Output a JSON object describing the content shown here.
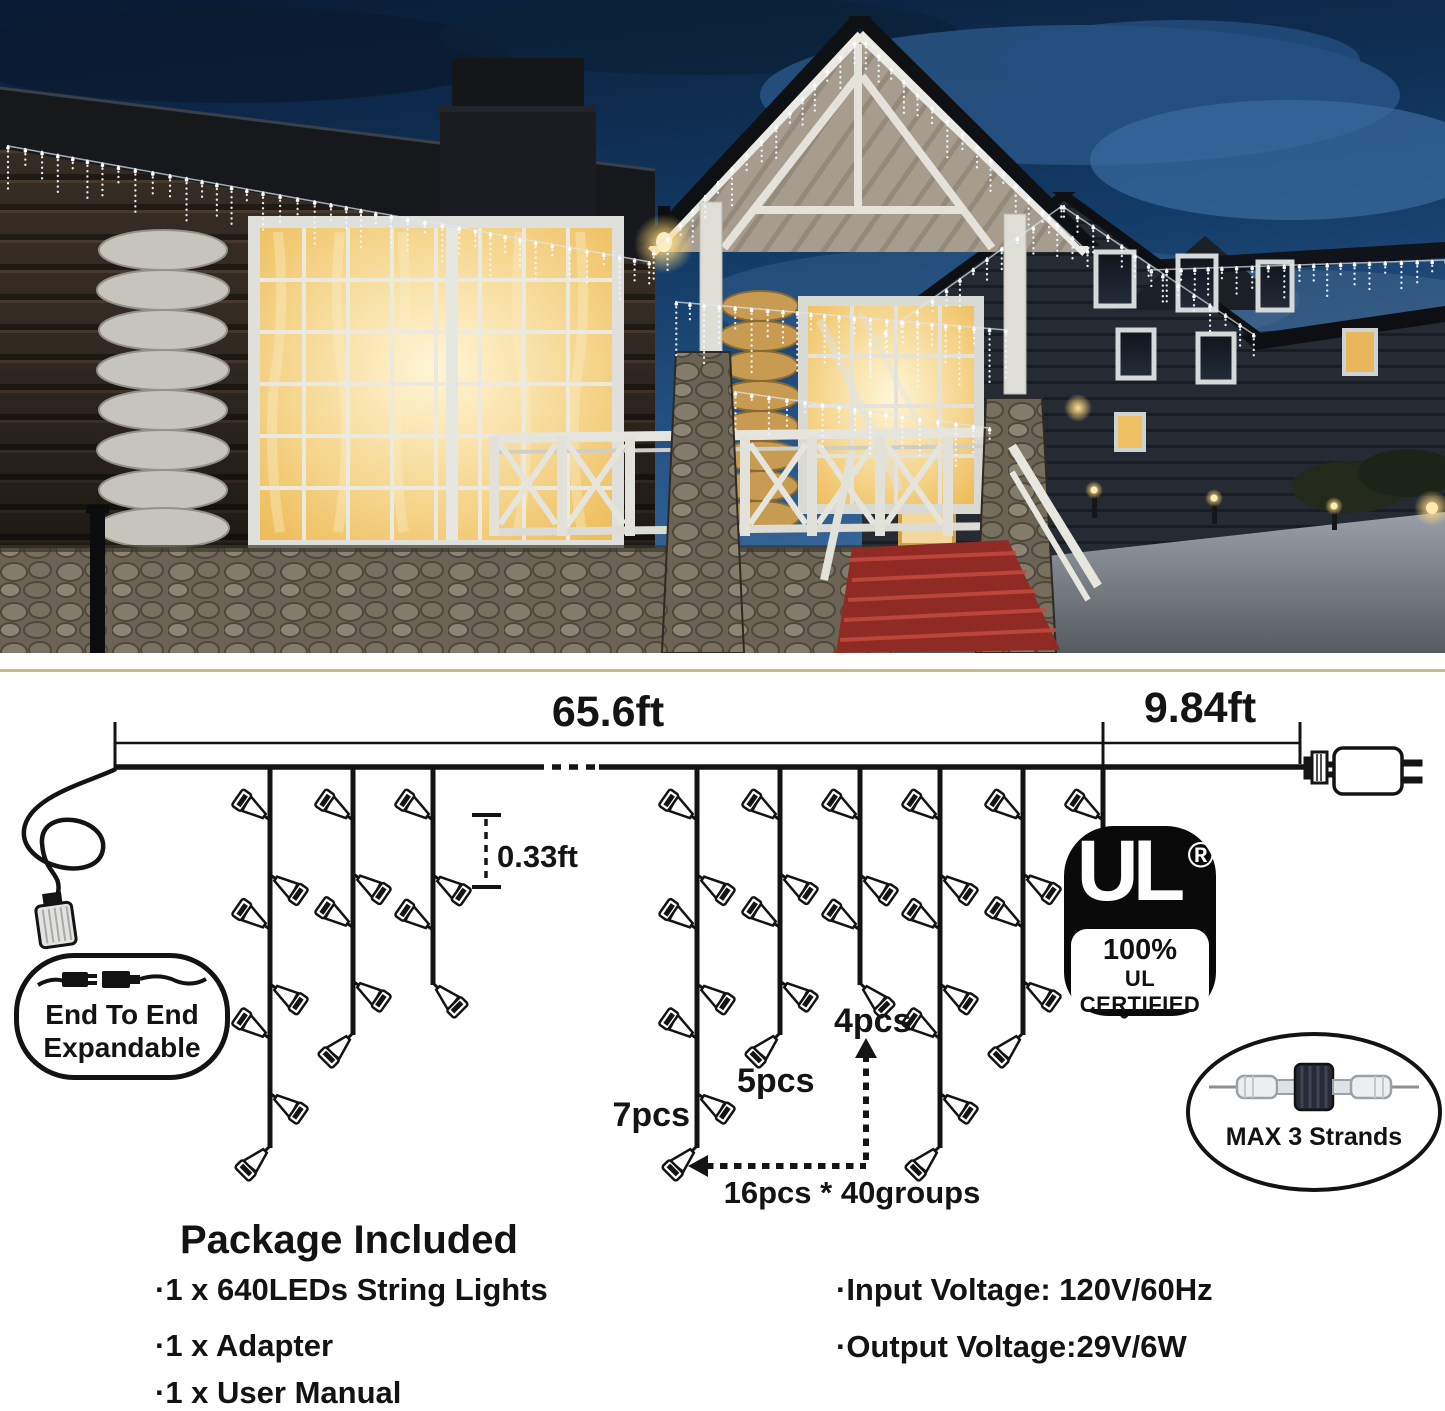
{
  "colors": {
    "divider": "#c9bb8b",
    "ink": "#131313",
    "window_glow": "#f3c96a",
    "carpet_red": "#8f2b24",
    "night_sky": "#143c68"
  },
  "photo": {
    "icon": "log-cabin-night-photo"
  },
  "diagram": {
    "dims": {
      "main_span": "65.6ft",
      "lead_span": "9.84ft",
      "drop_spacing": "0.33ft"
    },
    "drop_labels": {
      "long": "7pcs",
      "medium": "5pcs",
      "short": "4pcs"
    },
    "group_note": "16pcs * 40groups",
    "drops": [
      {
        "x": 270,
        "bulbs": 7,
        "bottom": 1148,
        "end": "L"
      },
      {
        "x": 353,
        "bulbs": 5,
        "bottom": 1035,
        "end": "L"
      },
      {
        "x": 433,
        "bulbs": 4,
        "bottom": 985,
        "end": "R"
      },
      {
        "x": 697,
        "bulbs": 7,
        "bottom": 1148,
        "end": "L"
      },
      {
        "x": 780,
        "bulbs": 5,
        "bottom": 1035,
        "end": "L"
      },
      {
        "x": 860,
        "bulbs": 4,
        "bottom": 985,
        "end": "R"
      },
      {
        "x": 940,
        "bulbs": 7,
        "bottom": 1148,
        "end": "L"
      },
      {
        "x": 1023,
        "bulbs": 5,
        "bottom": 1035,
        "end": "L"
      },
      {
        "x": 1103,
        "bulbs": 4,
        "bottom": 985,
        "end": "R"
      }
    ],
    "badge_end_to_end": {
      "line1": "End To End",
      "line2": "Expandable"
    },
    "badge_ul": {
      "brand": "UL",
      "registered": "®",
      "percent": "100%",
      "certified": "UL CERTIFIED"
    },
    "badge_connector": {
      "label": "MAX 3 Strands"
    },
    "package": {
      "title": "Package Included",
      "items": [
        "·1 x 640LEDs String Lights",
        "·1 x Adapter",
        "·1 x User Manual"
      ]
    },
    "specs": {
      "input": "·Input Voltage: 120V/60Hz",
      "output": "·Output Voltage:29V/6W"
    }
  }
}
